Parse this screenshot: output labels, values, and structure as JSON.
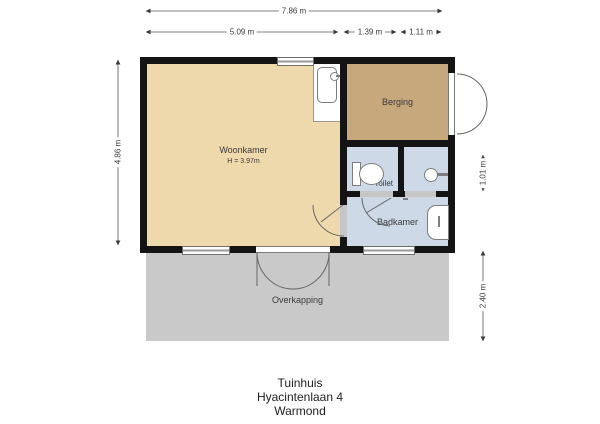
{
  "plan": {
    "title_lines": [
      "Tuinhuis",
      "Hyacintenlaan 4",
      "Warmond"
    ],
    "dimensions": {
      "total_width": "7.86 m",
      "woonkamer_width": "5.09 m",
      "toilet_section_width": "1.39 m",
      "basin_section_width": "1.11 m",
      "building_height": "4.86 m",
      "toilet_row_height": "1.01 m",
      "overkapping_depth": "2.40 m"
    },
    "rooms": {
      "woonkamer": {
        "label": "Woonkamer",
        "ceiling_note": "H = 3.97m",
        "color": "#eed9ad"
      },
      "berging": {
        "label": "Berging",
        "color": "#c7a87d"
      },
      "toilet": {
        "label": "Toilet",
        "color": "#cdd9e6"
      },
      "badkamer": {
        "label": "Badkamer",
        "color": "#cdd9e6"
      },
      "overkapping": {
        "label": "Overkapping",
        "color": "#c9c9c9"
      }
    },
    "colors": {
      "wall": "#141414",
      "fixture_outline": "#7d7d7d",
      "dimension_text": "#3a3a3a",
      "window_glass": "#9a9a9a"
    },
    "icons": {
      "shower_tray": "shower-tray-icon",
      "toilet_wc": "toilet-wc-icon",
      "hand_basin": "hand-basin-icon",
      "bathtub": "bathtub-icon",
      "door_swing": "door-swing-arc",
      "dimension_arrow": "dimension-arrow-icon"
    }
  }
}
